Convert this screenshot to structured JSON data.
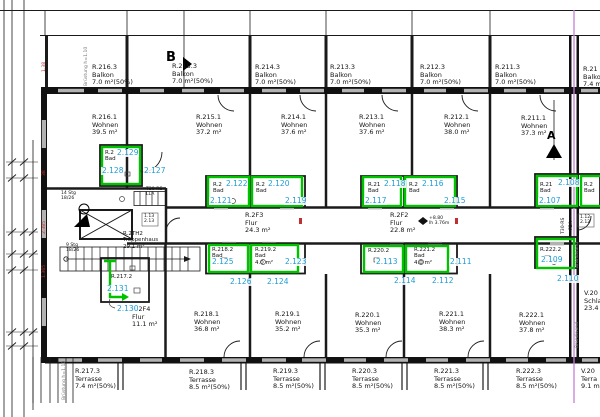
{
  "colors": {
    "highlight": "#00c300",
    "tag_blue": "#1e9cd7",
    "brandwand_line": "#c77fd4"
  },
  "markers": {
    "a": "A",
    "b": "B"
  },
  "balconies": [
    {
      "id": "R.216.3",
      "type": "Balkon",
      "area": "7.0 m²(50%)"
    },
    {
      "id": "R.215.3",
      "type": "Balkon",
      "area": "7.0 m²(50%)"
    },
    {
      "id": "R.214.3",
      "type": "Balkon",
      "area": "7.0 m²(50%)"
    },
    {
      "id": "R.213.3",
      "type": "Balkon",
      "area": "7.0 m²(50%)"
    },
    {
      "id": "R.212.3",
      "type": "Balkon",
      "area": "7.0 m²(50%)"
    },
    {
      "id": "R.211.3",
      "type": "Balkon",
      "area": "7.0 m²(50%)"
    },
    {
      "id": "R.21",
      "type": "Balkon",
      "area": "7.4 m"
    }
  ],
  "rooms_top": [
    {
      "id": "R.216.1",
      "type": "Wohnen",
      "area": "39.5 m²"
    },
    {
      "id": "R.215.1",
      "type": "Wohnen",
      "area": "37.2 m²"
    },
    {
      "id": "R.214.1",
      "type": "Wohnen",
      "area": "37.6 m²"
    },
    {
      "id": "R.213.1",
      "type": "Wohnen",
      "area": "37.6 m²"
    },
    {
      "id": "R.212.1",
      "type": "Wohnen",
      "area": "38.0 m²"
    },
    {
      "id": "R.211.1",
      "type": "Wohnen",
      "area": "37.3 m²"
    }
  ],
  "corridors": {
    "f3": {
      "id": "R.2F3",
      "type": "Flur",
      "area": "24.3 m²"
    },
    "f2": {
      "id": "R.2F2",
      "type": "Flur",
      "area": "22.8 m²"
    },
    "f4": {
      "id": "R.2F4",
      "type": "Flur",
      "area": "11.1 m²"
    },
    "stairwell": {
      "id": "R.2TH2",
      "type": "Treppenhaus",
      "area": "29.1 m²"
    }
  },
  "baths": {
    "b216": {
      "id": "R.2",
      "name": "Bad"
    },
    "f3_left": {
      "id": "R.2",
      "name": "Bad"
    },
    "f3_right": {
      "id": "R.2",
      "name": "Bad"
    },
    "b218": {
      "id": "R.218.2",
      "name": "Bad"
    },
    "b219": {
      "id": "R.219.2",
      "name": "Bad",
      "area": "4.0 m²"
    },
    "f2_left": {
      "id": "R.21",
      "name": "Bad"
    },
    "f2_right": {
      "id": "R.2",
      "name": "Bad"
    },
    "b220": {
      "id": "R.220.2"
    },
    "b221": {
      "id": "R.221.2",
      "name": "Bad",
      "area": "4.0 m²"
    },
    "right_top": {
      "id": "R.21",
      "name": "Bad"
    },
    "right_edge": {
      "id": "R.2",
      "name": "Bad"
    },
    "b222": {
      "id": "R.222.2"
    },
    "b217": {
      "id": "R.217.2"
    }
  },
  "tags": {
    "t107": "2.107",
    "t108": "2.108",
    "t109": "2.109",
    "t110": "2.110",
    "t111": "2.111",
    "t112": "2.112",
    "t113": "2.113",
    "t114": "2.114",
    "t115": "2.115",
    "t116": "2.116",
    "t117": "2.117",
    "t118": "2.118",
    "t119": "2.119",
    "t120": "2.120",
    "t121": "2.121",
    "t122": "2.122",
    "t123": "2.123",
    "t124": "2.124",
    "t125": "2.125",
    "t126": "2.126",
    "t127": "2.127",
    "t128": "2.128",
    "t129": "2.129",
    "t130": "2.130",
    "t131": "2.131"
  },
  "rooms_bottom": [
    {
      "id": "R.218.1",
      "type": "Wohnen",
      "area": "36.8 m²"
    },
    {
      "id": "R.219.1",
      "type": "Wohnen",
      "area": "35.2 m²"
    },
    {
      "id": "R.220.1",
      "type": "Wohnen",
      "area": "35.3 m²"
    },
    {
      "id": "R.221.1",
      "type": "Wohnen",
      "area": "38.3 m²"
    },
    {
      "id": "R.222.1",
      "type": "Wohnen",
      "area": "37.8 m²"
    }
  ],
  "v_rooms": {
    "schlafen": {
      "id": "V.20",
      "type": "Schla",
      "area": "23.4 m"
    },
    "terrasse": {
      "id": "V.20",
      "type": "Terra",
      "area": "9.1 m"
    }
  },
  "terraces": [
    {
      "id": "R.217.3",
      "type": "Terrasse",
      "area": "7.4 m²(50%)"
    },
    {
      "id": "R.218.3",
      "type": "Terrasse",
      "area": "8.5 m²(50%)"
    },
    {
      "id": "R.219.3",
      "type": "Terrasse",
      "area": "8.5 m²(50%)"
    },
    {
      "id": "R.220.3",
      "type": "Terrasse",
      "area": "8.5 m²(50%)"
    },
    {
      "id": "R.221.3",
      "type": "Terrasse",
      "area": "8.5 m²(50%)"
    },
    {
      "id": "R.222.3",
      "type": "Terrasse",
      "area": "8.5 m²(50%)"
    }
  ],
  "stairs": {
    "upper_count": "14 Stg",
    "upper_rise": "18/26",
    "lower_count": "9 Stg",
    "lower_rise": "18/26"
  },
  "door_tags": {
    "t30rs": "T30-RS",
    "lla": "LLA",
    "t30rs_right": "T30-RS",
    "fsa": "FSA",
    "d112": "1.12",
    "d212": "2.12",
    "d113": "1.13",
    "d213": "2.13"
  },
  "level_marker": {
    "elevation": "+8.80",
    "clear_height": "lh 3.76m"
  },
  "annotations": {
    "brandwand": "Brandwand",
    "bruestung": "Brüstung h=1.10",
    "dim1": "1.38",
    "dim2": "38",
    "dim3": "2.385",
    "dim4": "1.365"
  }
}
